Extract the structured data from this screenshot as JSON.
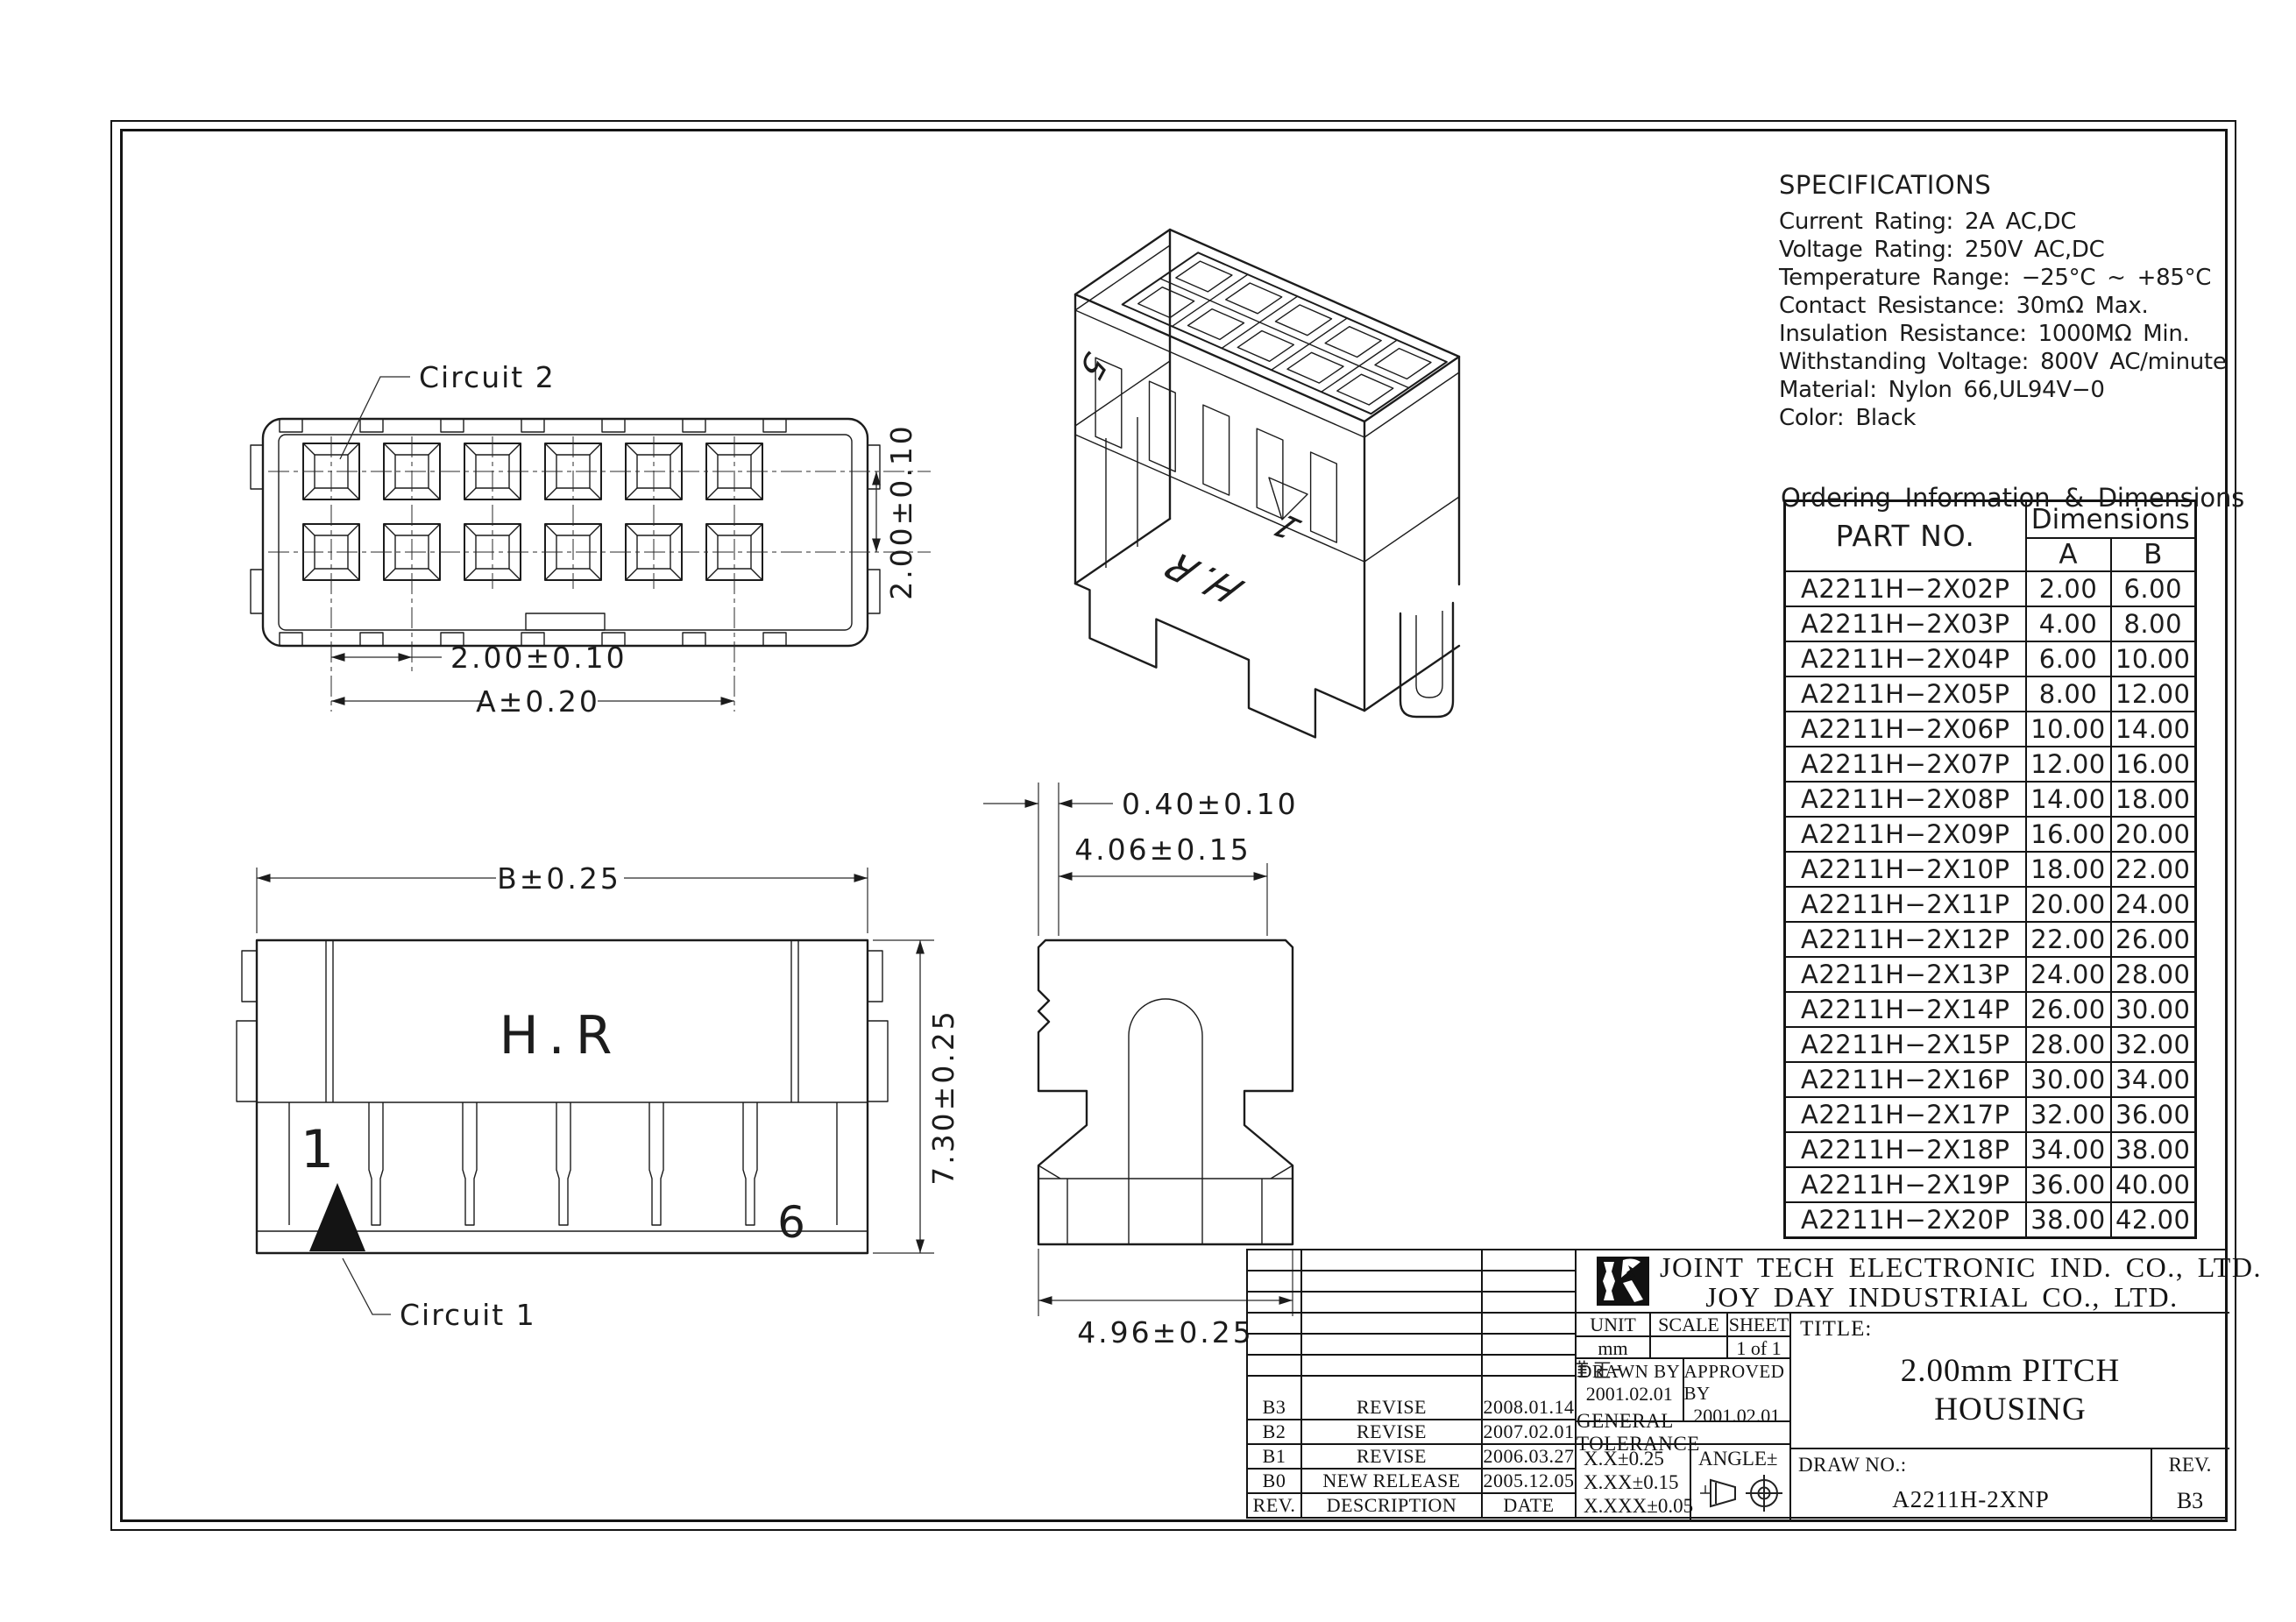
{
  "colors": {
    "line": "#1c1c1c",
    "background": "#ffffff"
  },
  "views": {
    "rear": {
      "circuit2_label": "Circuit 2",
      "dim_pitch_h": "2.00±0.10",
      "dim_a": "A±0.20",
      "dim_pitch_v": "2.00±0.10"
    },
    "side": {
      "dim_b": "B±0.25",
      "brand": "H.R",
      "pos_first": "1",
      "pos_last": "6",
      "dim_height": "7.30±0.25",
      "circuit1_label": "Circuit 1"
    },
    "section": {
      "dim_lip": "0.40±0.10",
      "dim_inner": "4.06±0.15",
      "dim_outer": "4.96±0.25"
    },
    "iso": {
      "pos_last": "5",
      "pos_first": "1",
      "brand": "H.R"
    }
  },
  "specs": {
    "title": "SPECIFICATIONS",
    "lines": [
      "Current Rating: 2A AC,DC",
      "Voltage Rating: 250V AC,DC",
      "Temperature Range: −25°C ~ +85°C",
      "Contact Resistance: 30mΩ Max.",
      "Insulation Resistance: 1000MΩ Min.",
      "Withstanding Voltage: 800V AC/minute",
      "Material: Nylon 66,UL94V−0",
      "Color: Black"
    ]
  },
  "ordering": {
    "title": "Ordering Information & Dimensions",
    "col_part": "PART NO.",
    "col_dims": "Dimensions",
    "col_a": "A",
    "col_b": "B",
    "rows": [
      {
        "part": "A2211H−2X02P",
        "a": "2.00",
        "b": "6.00"
      },
      {
        "part": "A2211H−2X03P",
        "a": "4.00",
        "b": "8.00"
      },
      {
        "part": "A2211H−2X04P",
        "a": "6.00",
        "b": "10.00"
      },
      {
        "part": "A2211H−2X05P",
        "a": "8.00",
        "b": "12.00"
      },
      {
        "part": "A2211H−2X06P",
        "a": "10.00",
        "b": "14.00"
      },
      {
        "part": "A2211H−2X07P",
        "a": "12.00",
        "b": "16.00"
      },
      {
        "part": "A2211H−2X08P",
        "a": "14.00",
        "b": "18.00"
      },
      {
        "part": "A2211H−2X09P",
        "a": "16.00",
        "b": "20.00"
      },
      {
        "part": "A2211H−2X10P",
        "a": "18.00",
        "b": "22.00"
      },
      {
        "part": "A2211H−2X11P",
        "a": "20.00",
        "b": "24.00"
      },
      {
        "part": "A2211H−2X12P",
        "a": "22.00",
        "b": "26.00"
      },
      {
        "part": "A2211H−2X13P",
        "a": "24.00",
        "b": "28.00"
      },
      {
        "part": "A2211H−2X14P",
        "a": "26.00",
        "b": "30.00"
      },
      {
        "part": "A2211H−2X15P",
        "a": "28.00",
        "b": "32.00"
      },
      {
        "part": "A2211H−2X16P",
        "a": "30.00",
        "b": "34.00"
      },
      {
        "part": "A2211H−2X17P",
        "a": "32.00",
        "b": "36.00"
      },
      {
        "part": "A2211H−2X18P",
        "a": "34.00",
        "b": "38.00"
      },
      {
        "part": "A2211H−2X19P",
        "a": "36.00",
        "b": "40.00"
      },
      {
        "part": "A2211H−2X20P",
        "a": "38.00",
        "b": "42.00"
      }
    ]
  },
  "title_block": {
    "company_line1": "JOINT TECH ELECTRONIC IND. CO., LTD.",
    "company_line2": "JOY DAY INDUSTRIAL CO., LTD.",
    "unit_label": "UNIT",
    "unit_value": "mm",
    "scale_label": "SCALE",
    "scale_value": "",
    "sheet_label": "SHEET",
    "sheet_value": "1 of 1",
    "drawn_label": "DRAWN BY",
    "drawn_stamp": "董正-",
    "drawn_date": "2001.02.01",
    "approved_label": "APPROVED BY",
    "approved_stamp": "董正-",
    "approved_date": "2001.02.01",
    "general_tolerance": "GENERAL TOLERANCE",
    "tol1": "X.X±0.25",
    "tol2": "X.XX±0.15",
    "tol3": "X.XXX±0.05",
    "angle_label": "ANGLE±",
    "title_label": "TITLE:",
    "title_line1": "2.00mm PITCH",
    "title_line2": "HOUSING",
    "drawno_label": "DRAW NO.:",
    "drawno_value": "A2211H-2XNP",
    "rev_label": "REV.",
    "rev_value": "B3",
    "rev_header": {
      "rev": "REV.",
      "desc": "DESCRIPTION",
      "date": "DATE"
    },
    "revisions": [
      {
        "rev": "B3",
        "desc": "REVISE",
        "date": "2008.01.14"
      },
      {
        "rev": "B2",
        "desc": "REVISE",
        "date": "2007.02.01"
      },
      {
        "rev": "B1",
        "desc": "REVISE",
        "date": "2006.03.27"
      },
      {
        "rev": "B0",
        "desc": "NEW RELEASE",
        "date": "2005.12.05"
      }
    ]
  }
}
